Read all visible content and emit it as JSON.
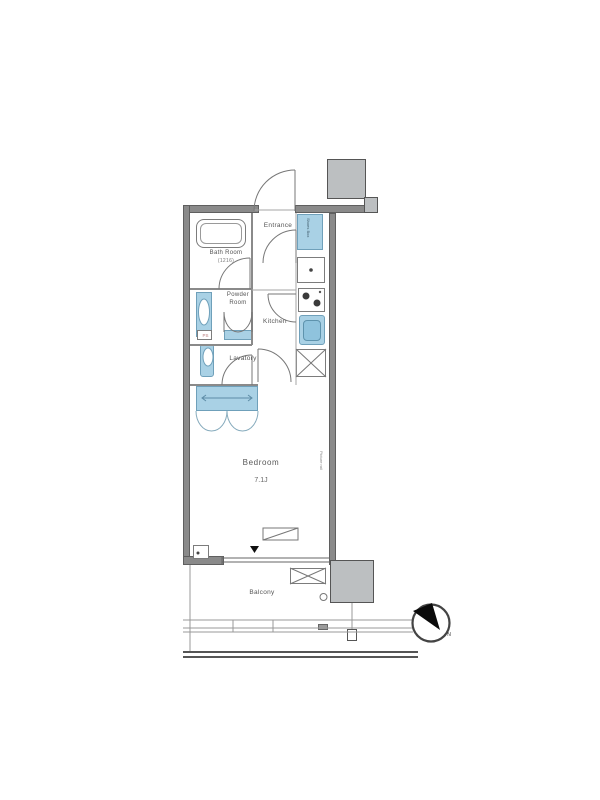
{
  "floorplan": {
    "labels": {
      "entrance": "Entrance",
      "shoes_box": "Shoes Box",
      "bath_room": "Bath Room",
      "bath_room_size": "(1216)",
      "powder_room": "Powder Room",
      "kitchen": "Kitchen",
      "lavatory": "Lavatory",
      "pipe_space": "PS",
      "bedroom": "Bedroom",
      "bedroom_size": "7.1J",
      "picture_rail": "Picture rail",
      "balcony": "Balcony",
      "compass_north": "N"
    },
    "colors": {
      "fixture_blue": "#a9d1e5",
      "wall_gray": "#8a8a8a",
      "shaft_gray": "#bcbfc1",
      "line_gray": "#777777"
    }
  }
}
